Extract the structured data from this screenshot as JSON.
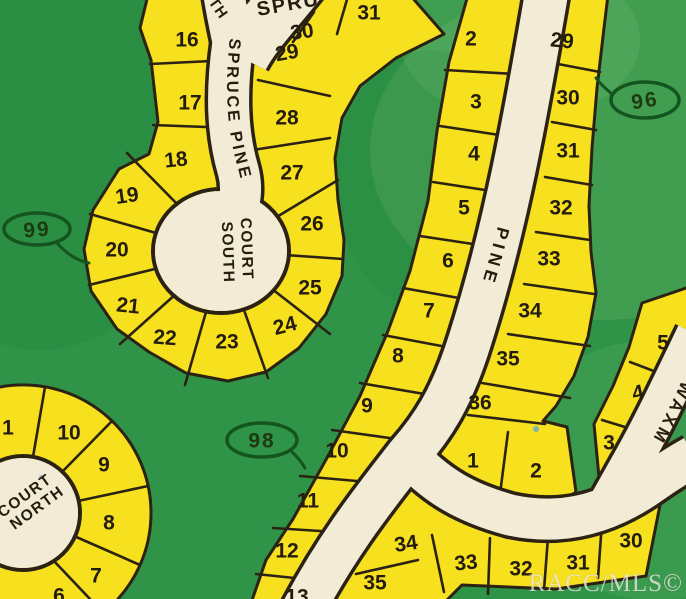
{
  "watermark": "RACC/MLS©",
  "streets": {
    "spruce_pine": "SPRUCE PINE",
    "pine": "PINE",
    "waxmyrtle_partial": "WAXM",
    "north_partial": "TH",
    "spruce_partial": "SPRU"
  },
  "culdesacs": {
    "south_line1": "COURT",
    "south_line2": "SOUTH",
    "north_line1": "COURT",
    "north_line2": "NORTH"
  },
  "area_badges": [
    {
      "value": "99"
    },
    {
      "value": "96"
    },
    {
      "value": "98"
    }
  ],
  "colors": {
    "grass": "#2F9447",
    "grass_light": "#8CC87E",
    "lot_yellow": "#F7E01E",
    "road_cream": "#F2ECD6",
    "outline": "#2B2214",
    "number_ink": "#241C0D",
    "badge_green": "#14541F",
    "watermark": "#EDEAE4",
    "speck_blue": "#5FA8D6"
  },
  "lots": [
    {
      "n": "16",
      "x": 187,
      "y": 40,
      "r": 0
    },
    {
      "n": "17",
      "x": 190,
      "y": 103,
      "r": 0
    },
    {
      "n": "18",
      "x": 176,
      "y": 160,
      "r": -6
    },
    {
      "n": "19",
      "x": 127,
      "y": 196,
      "r": -8
    },
    {
      "n": "20",
      "x": 117,
      "y": 250,
      "r": 0
    },
    {
      "n": "21",
      "x": 128,
      "y": 306,
      "r": 6
    },
    {
      "n": "22",
      "x": 165,
      "y": 338,
      "r": 4
    },
    {
      "n": "23",
      "x": 227,
      "y": 342,
      "r": 0
    },
    {
      "n": "24",
      "x": 285,
      "y": 326,
      "r": -15
    },
    {
      "n": "25",
      "x": 310,
      "y": 288,
      "r": 0
    },
    {
      "n": "26",
      "x": 312,
      "y": 224,
      "r": 0
    },
    {
      "n": "27",
      "x": 292,
      "y": 173,
      "r": 0
    },
    {
      "n": "28",
      "x": 287,
      "y": 118,
      "r": 0
    },
    {
      "n": "29",
      "x": 287,
      "y": 53,
      "r": -10
    },
    {
      "n": "30",
      "x": 302,
      "y": 32,
      "r": -8
    },
    {
      "n": "31",
      "x": 369,
      "y": 13,
      "r": 0
    },
    {
      "n": "2",
      "x": 471,
      "y": 39,
      "r": 0
    },
    {
      "n": "3",
      "x": 476,
      "y": 102,
      "r": 0
    },
    {
      "n": "4",
      "x": 474,
      "y": 154,
      "r": 0
    },
    {
      "n": "5",
      "x": 464,
      "y": 208,
      "r": 0
    },
    {
      "n": "6",
      "x": 448,
      "y": 261,
      "r": 0
    },
    {
      "n": "7",
      "x": 429,
      "y": 311,
      "r": 0
    },
    {
      "n": "8",
      "x": 398,
      "y": 356,
      "r": 0
    },
    {
      "n": "9",
      "x": 367,
      "y": 406,
      "r": 0
    },
    {
      "n": "10",
      "x": 337,
      "y": 451,
      "r": 0
    },
    {
      "n": "11",
      "x": 308,
      "y": 501,
      "r": 0
    },
    {
      "n": "12",
      "x": 287,
      "y": 551,
      "r": 0
    },
    {
      "n": "13",
      "x": 297,
      "y": 597,
      "r": 0
    },
    {
      "n": "29",
      "x": 562,
      "y": 41,
      "r": 6
    },
    {
      "n": "30",
      "x": 568,
      "y": 98,
      "r": 0
    },
    {
      "n": "31",
      "x": 568,
      "y": 151,
      "r": 0
    },
    {
      "n": "32",
      "x": 561,
      "y": 208,
      "r": 0
    },
    {
      "n": "33",
      "x": 549,
      "y": 259,
      "r": 0
    },
    {
      "n": "34",
      "x": 530,
      "y": 311,
      "r": 0
    },
    {
      "n": "35",
      "x": 508,
      "y": 359,
      "r": 0
    },
    {
      "n": "36",
      "x": 480,
      "y": 403,
      "r": 0
    },
    {
      "n": "1",
      "x": 473,
      "y": 461,
      "r": 0
    },
    {
      "n": "2",
      "x": 536,
      "y": 471,
      "r": 0
    },
    {
      "n": "3",
      "x": 609,
      "y": 443,
      "r": 0
    },
    {
      "n": "4",
      "x": 638,
      "y": 393,
      "r": -12
    },
    {
      "n": "5",
      "x": 663,
      "y": 343,
      "r": 0
    },
    {
      "n": "34",
      "x": 406,
      "y": 544,
      "r": -8
    },
    {
      "n": "35",
      "x": 375,
      "y": 583,
      "r": 0
    },
    {
      "n": "33",
      "x": 466,
      "y": 563,
      "r": -6
    },
    {
      "n": "32",
      "x": 521,
      "y": 569,
      "r": 0
    },
    {
      "n": "31",
      "x": 578,
      "y": 563,
      "r": 0
    },
    {
      "n": "30",
      "x": 631,
      "y": 541,
      "r": 0
    },
    {
      "n": "1",
      "x": 8,
      "y": 428,
      "r": 0
    },
    {
      "n": "10",
      "x": 69,
      "y": 433,
      "r": 0
    },
    {
      "n": "9",
      "x": 104,
      "y": 465,
      "r": 0
    },
    {
      "n": "8",
      "x": 109,
      "y": 523,
      "r": 0
    },
    {
      "n": "7",
      "x": 96,
      "y": 576,
      "r": 0
    },
    {
      "n": "6",
      "x": 59,
      "y": 596,
      "r": 0
    }
  ]
}
